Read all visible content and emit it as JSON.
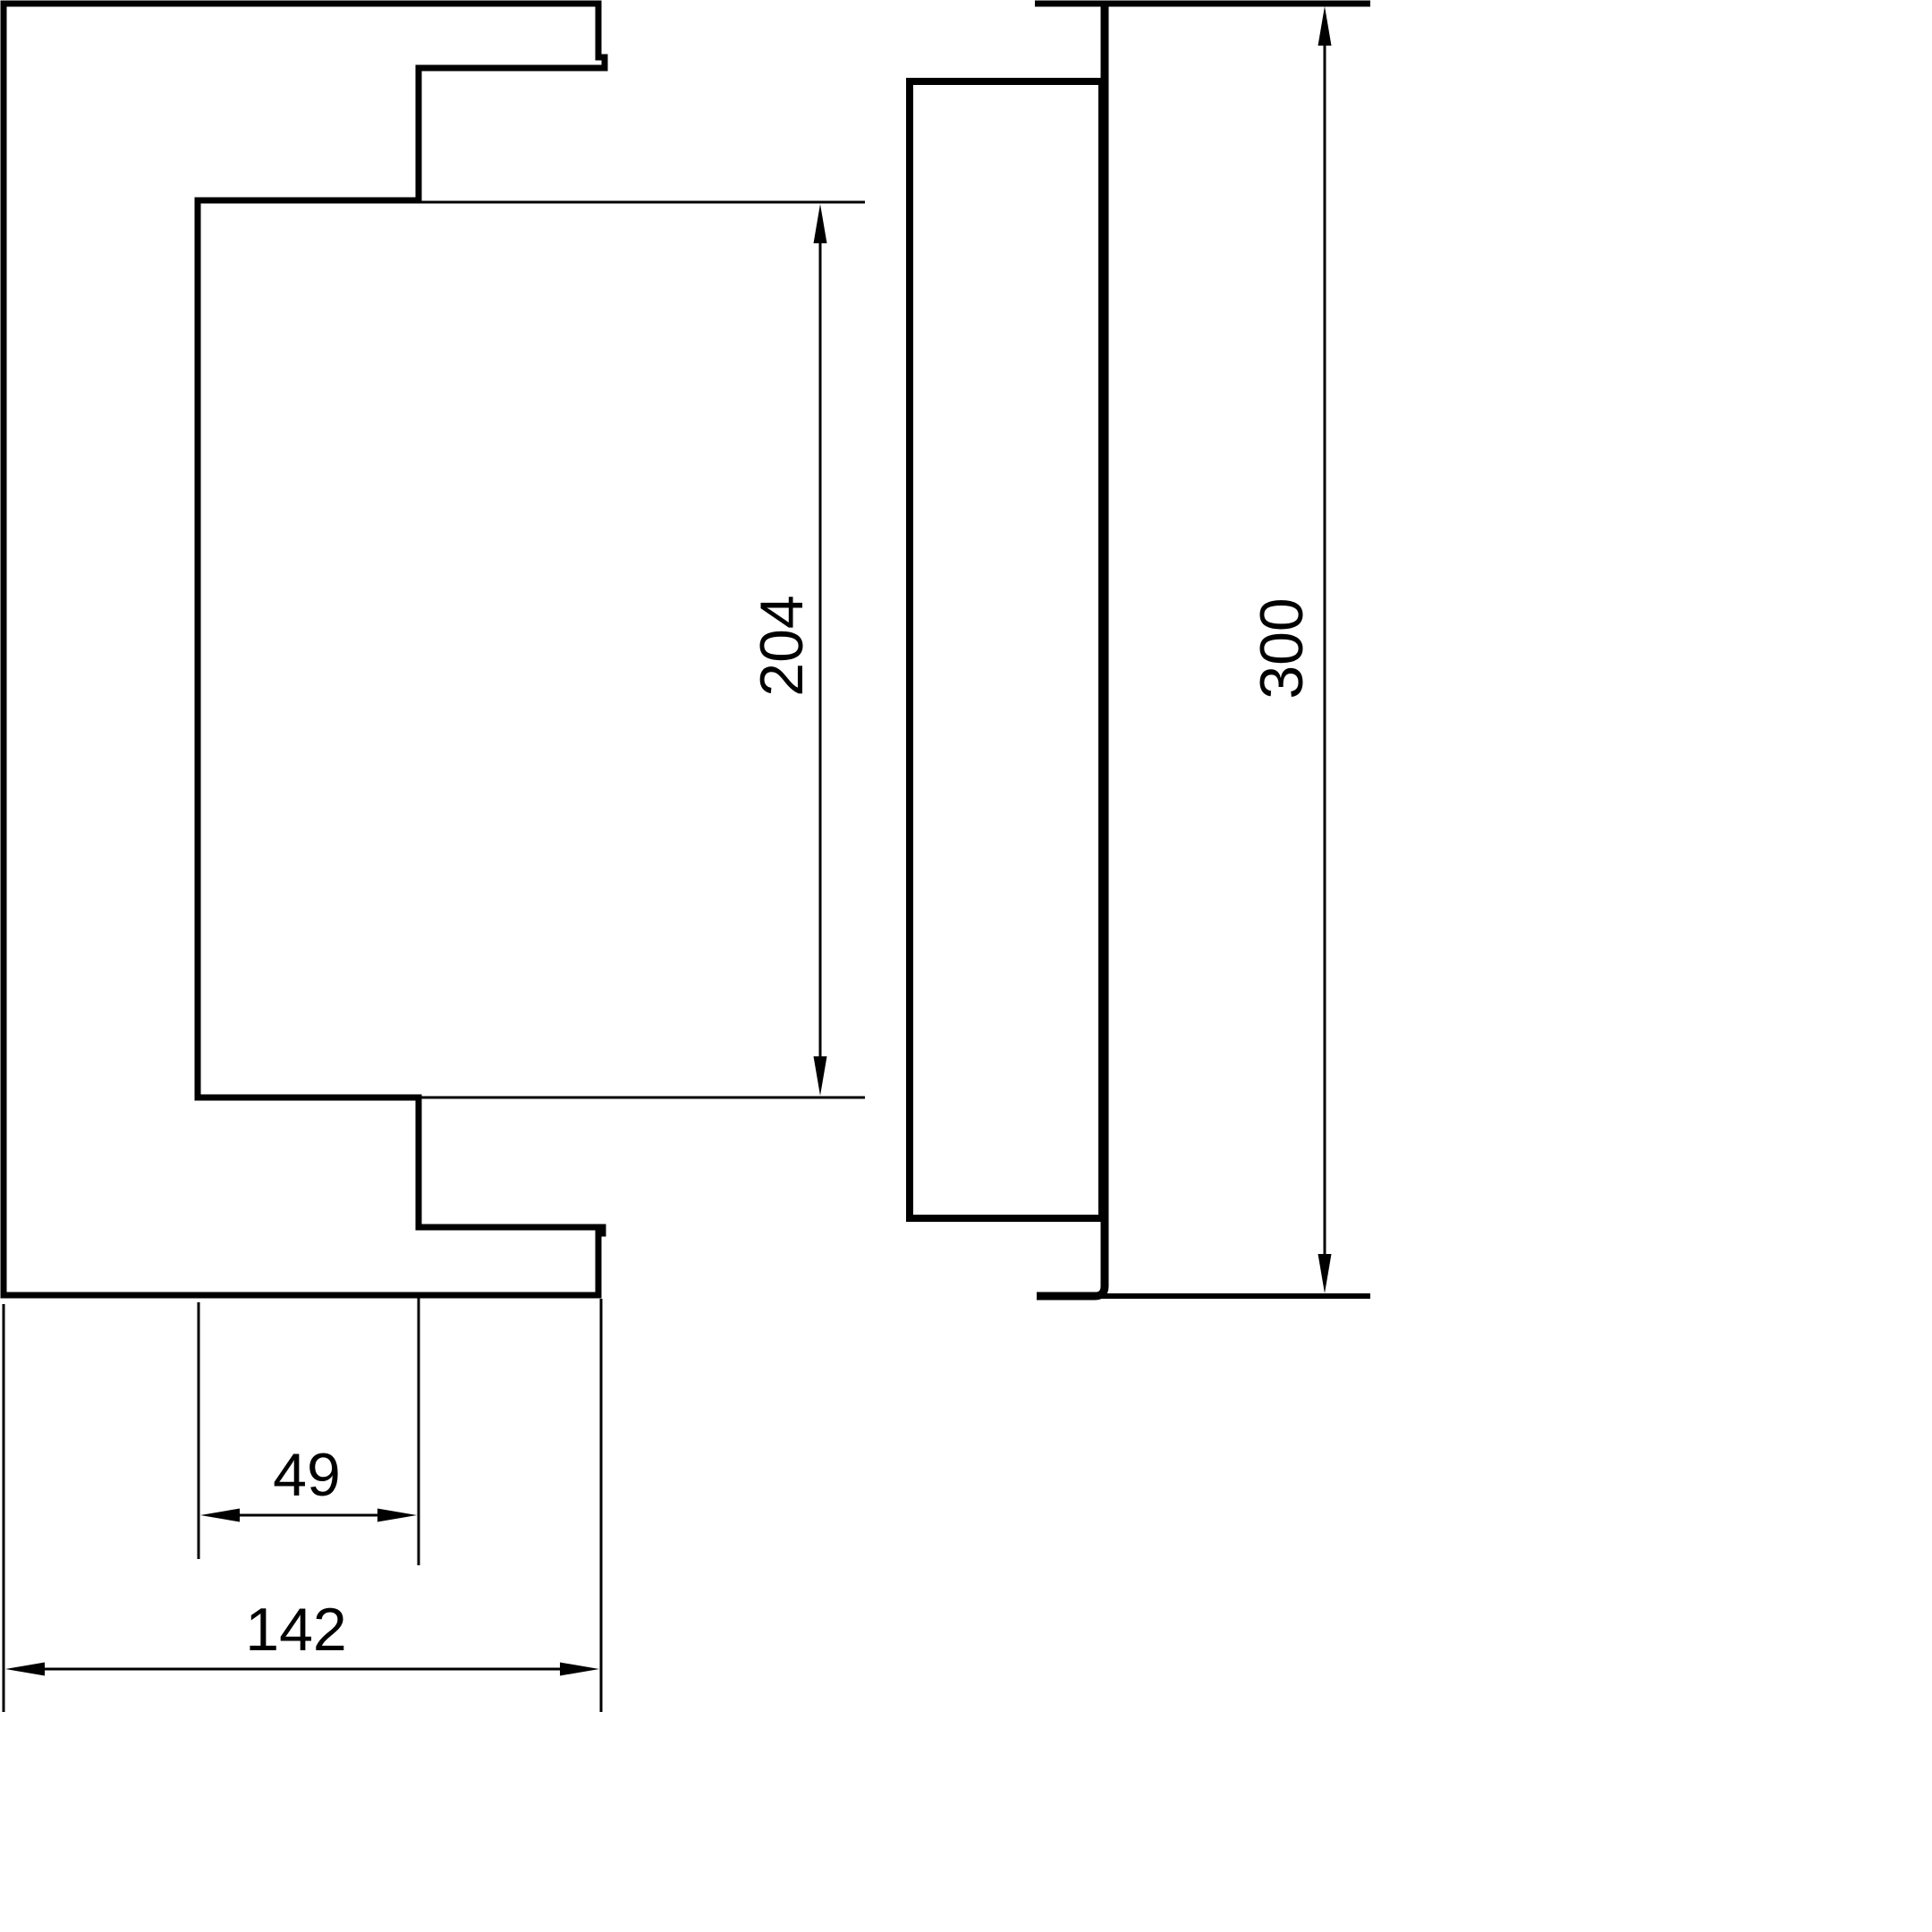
{
  "drawing": {
    "dimensions": {
      "opening_height": "204",
      "panel_height": "300",
      "rebate_width": "49",
      "frame_width": "142"
    },
    "colors": {
      "shape_fill": "#ebebeb",
      "line": "#000000",
      "background": "#ffffff"
    }
  }
}
